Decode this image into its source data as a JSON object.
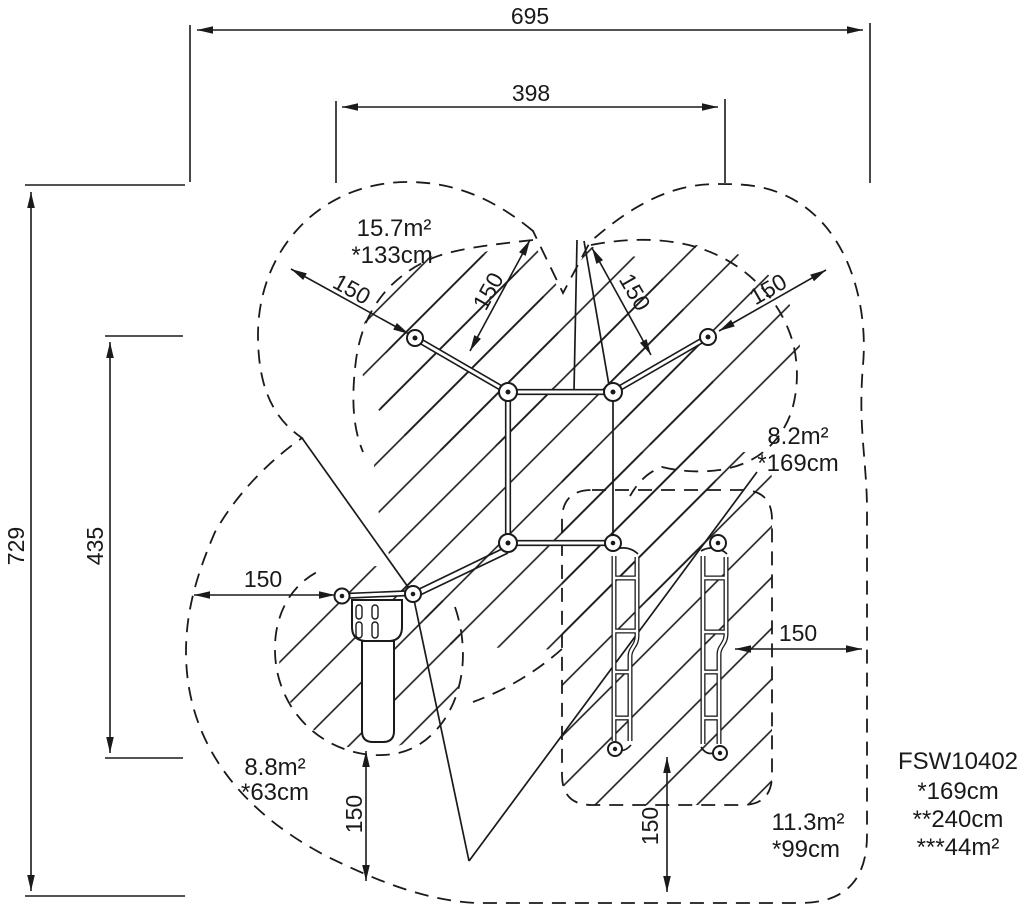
{
  "dimensions": {
    "overall_width": "695",
    "inner_width": "398",
    "overall_height": "729",
    "inner_height": "435",
    "clearance": "150"
  },
  "zones": [
    {
      "area": "15.7m²",
      "height": "*133cm"
    },
    {
      "area": "8.2m²",
      "height": "*169cm"
    },
    {
      "area": "8.8m²",
      "height": "*63cm"
    },
    {
      "area": "11.3m²",
      "height": "*99cm"
    }
  ],
  "product": {
    "code": "FSW10402",
    "spec1": "*169cm",
    "spec2": "**240cm",
    "spec3": "***44m²"
  },
  "colors": {
    "line": "#1a1a1a",
    "background": "#ffffff"
  }
}
